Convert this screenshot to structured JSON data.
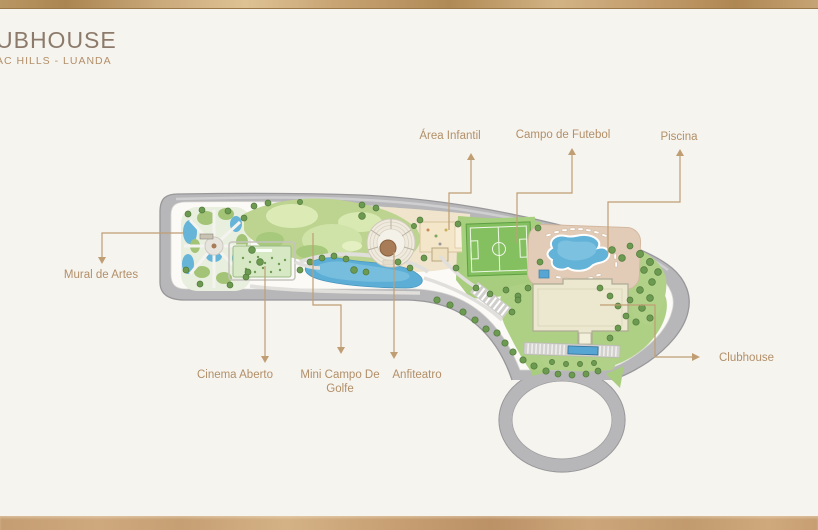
{
  "header": {
    "title": "UBHOUSE",
    "subtitle": "AC HILLS - LUANDA"
  },
  "labels": {
    "mural_de_artes": "Mural de Artes",
    "cinema_aberto": "Cinema Aberto",
    "mini_campo_line1": "Mini Campo De",
    "mini_campo_line2": "Golfe",
    "anfiteatro": "Anfiteatro",
    "area_infantil": "Área Infantil",
    "campo_de_futebol": "Campo de Futebol",
    "piscina": "Piscina",
    "clubhouse": "Clubhouse"
  },
  "colors": {
    "background": "#f6f4ef",
    "gold_accent": "#c09e74",
    "title_text": "#8c7b6b",
    "label_text": "#b28f68",
    "road_gray": "#b7b6b8",
    "water_blue": "#5caed6",
    "lawn_green": "#a8cd7e",
    "golf_light_green": "#d5e7ae",
    "field_green": "#84c060",
    "pool_deck_tan": "#e2ccb8",
    "building_cream": "#ece8cf",
    "playground_tan": "#f4e6c8"
  }
}
